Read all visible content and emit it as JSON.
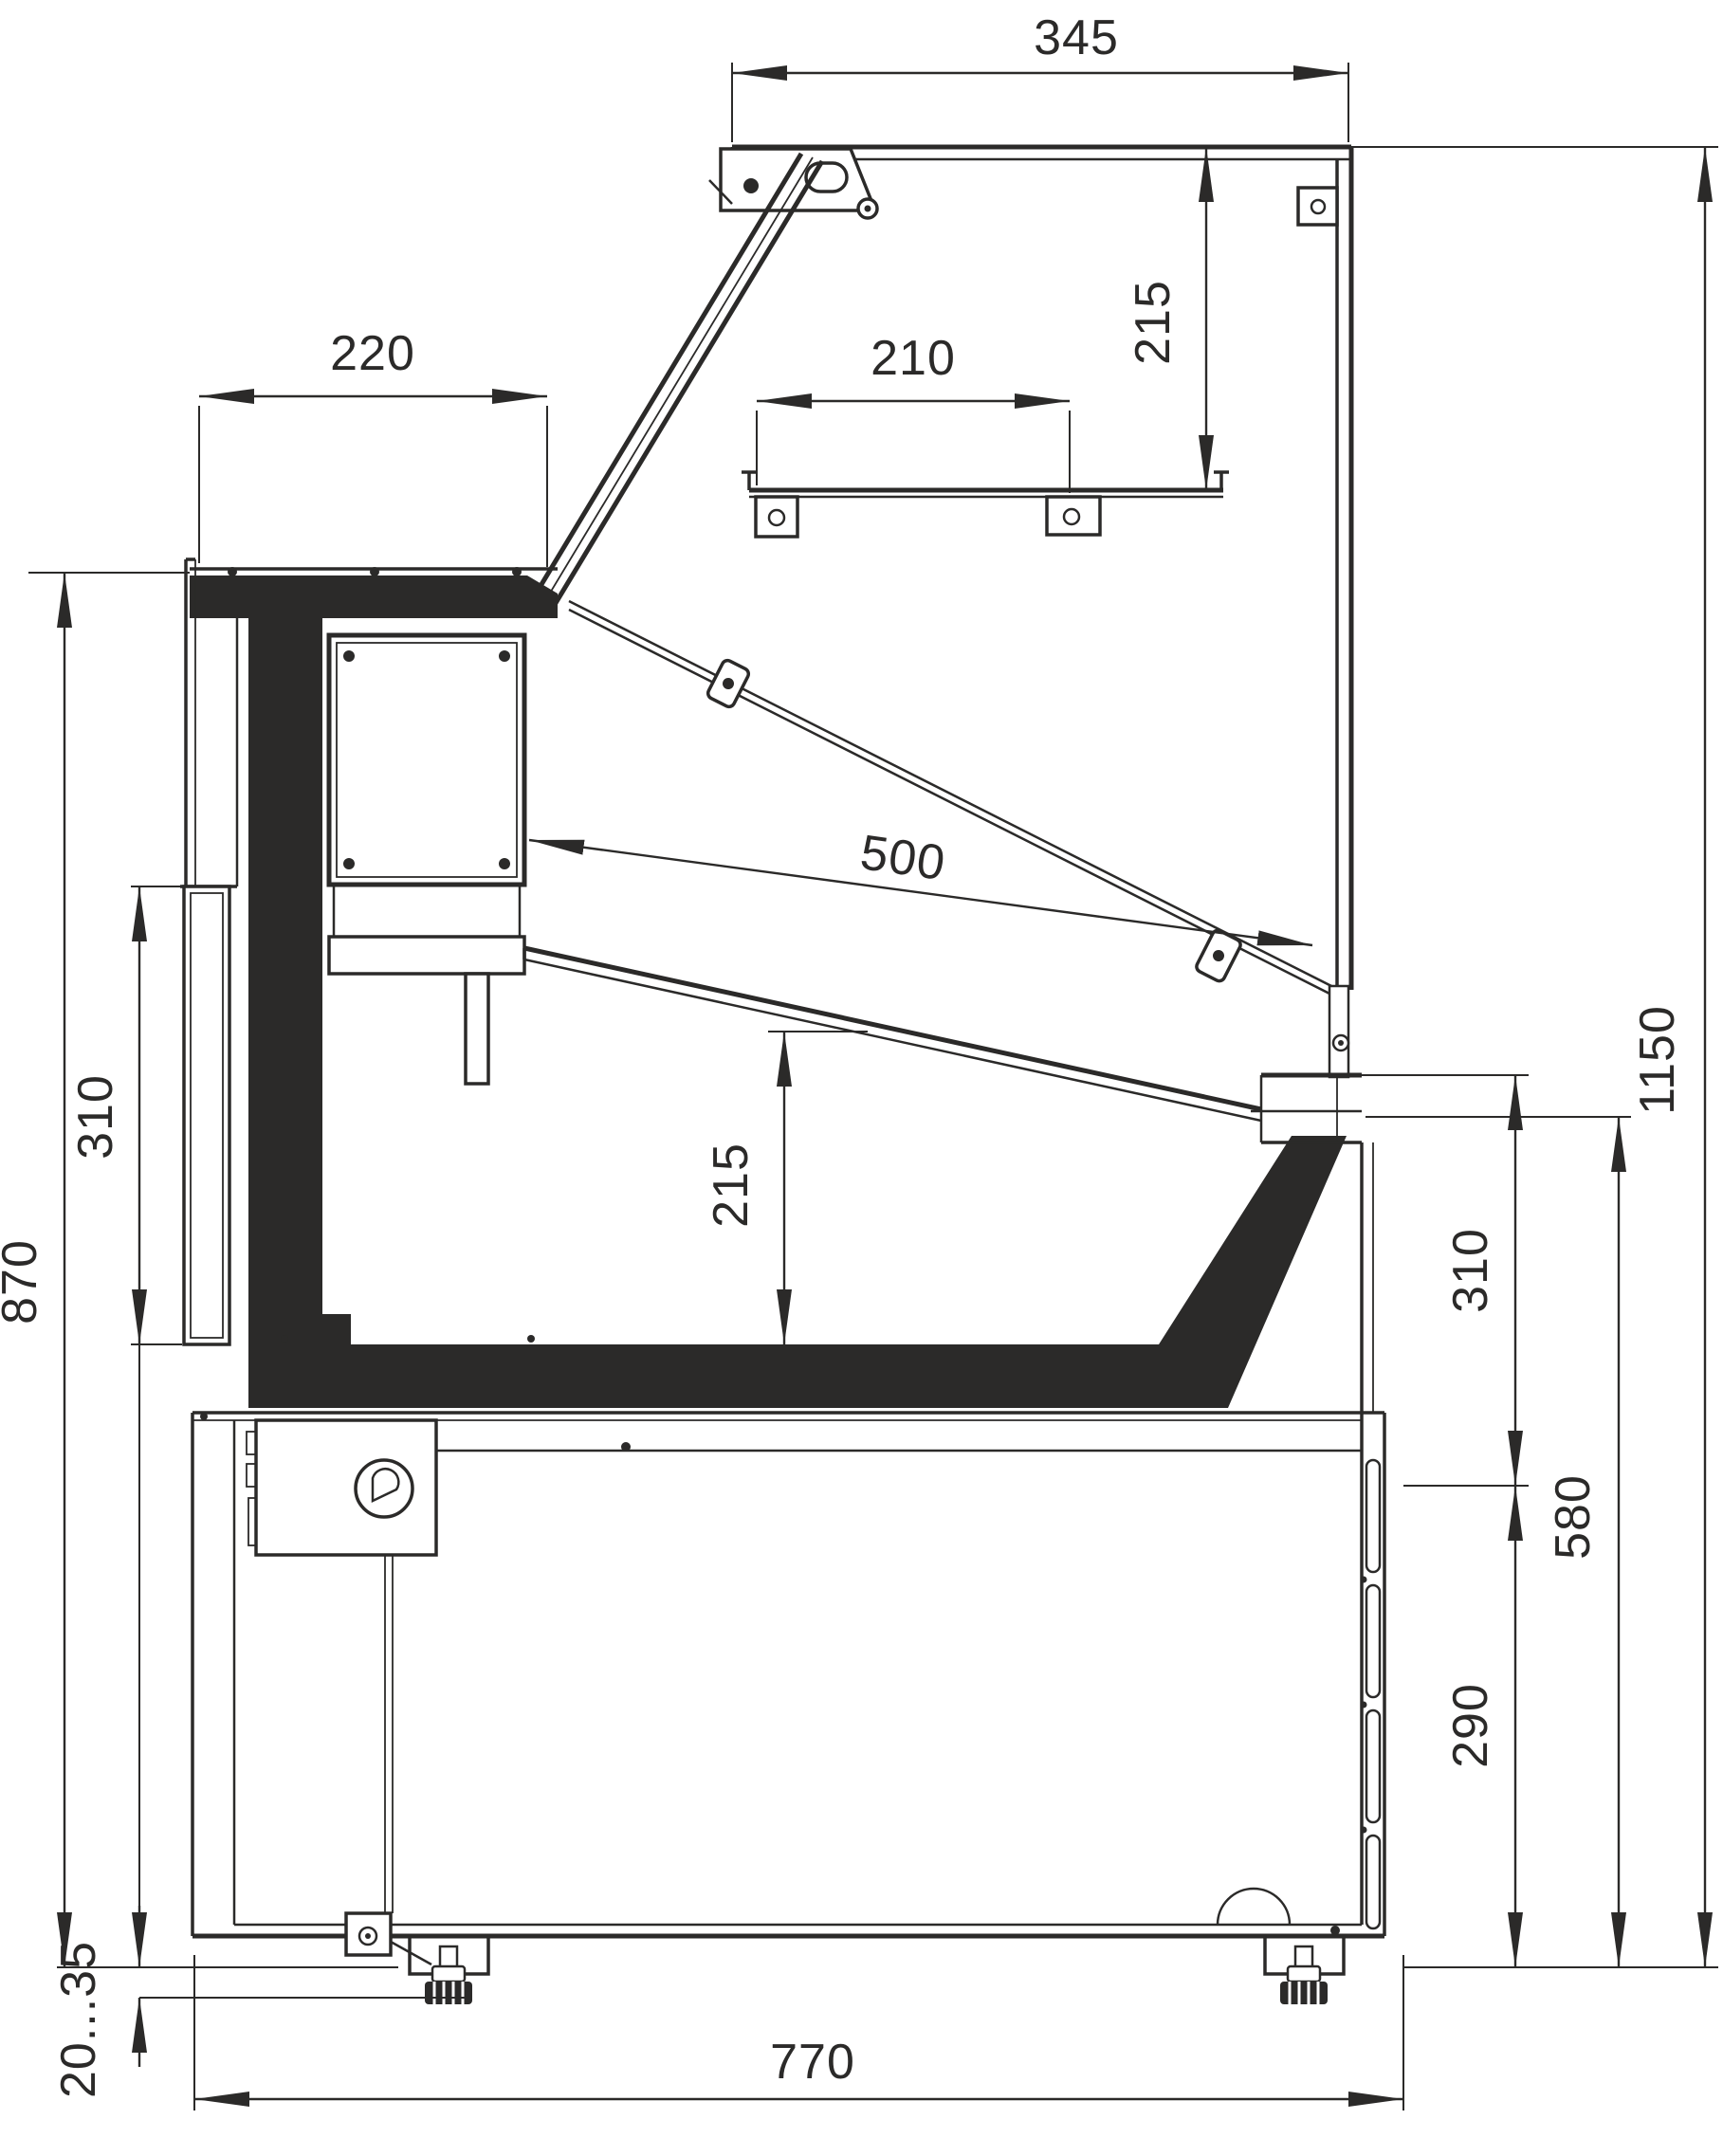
{
  "drawing": {
    "subject": "Refrigerated serve-over display counter - side cross-section",
    "type": "dimensioned technical drawing",
    "units": "mm",
    "line_color": "#2b2a29",
    "background_color": "#ffffff",
    "dims": {
      "d345": "345",
      "d215_top": "215",
      "d220": "220",
      "d210": "210",
      "d500": "500",
      "d215_mid": "215",
      "d310_left": "310",
      "d870": "870",
      "d1150": "1150",
      "d310_right": "310",
      "d580": "580",
      "d290": "290",
      "d770": "770",
      "d_feet": "20...35"
    }
  }
}
